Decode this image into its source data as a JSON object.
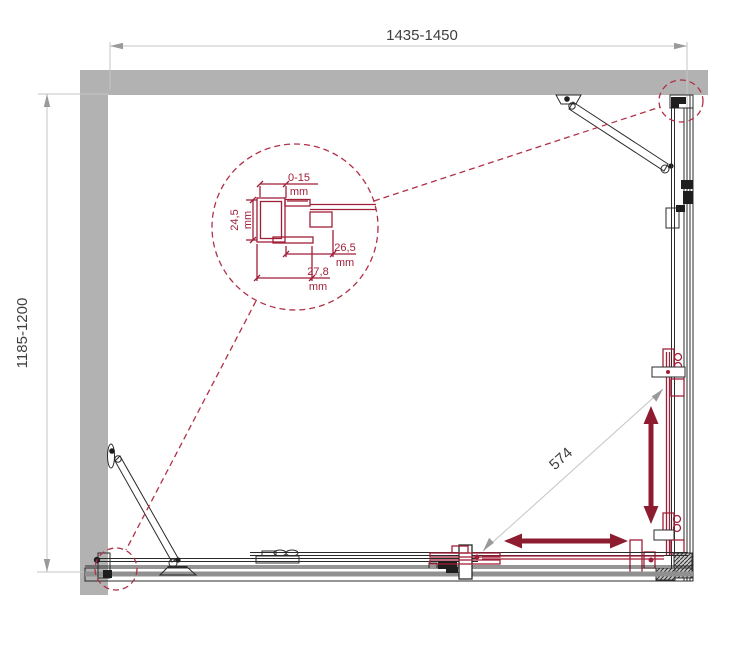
{
  "dimensions": {
    "width": "1435-1450",
    "depth": "1185-1200",
    "diagonal": "574"
  },
  "detail": {
    "adjust_value": "0-15",
    "adjust_unit": "mm",
    "profile_depth_value": "24,5",
    "profile_depth_unit": "mm",
    "dim26_value": "26,5",
    "dim26_unit": "mm",
    "dim27_value": "27,8",
    "dim27_unit": "mm"
  },
  "colors": {
    "wall_gray": "#b2b2b2",
    "rail_gray": "#909090",
    "drawing_black": "#2b2b2b",
    "accent_red": "#a01f38",
    "arrow_red": "#8e1c30",
    "dim_line_gray": "#c4c4c4",
    "dim_text_gray": "#3f3f3f"
  }
}
